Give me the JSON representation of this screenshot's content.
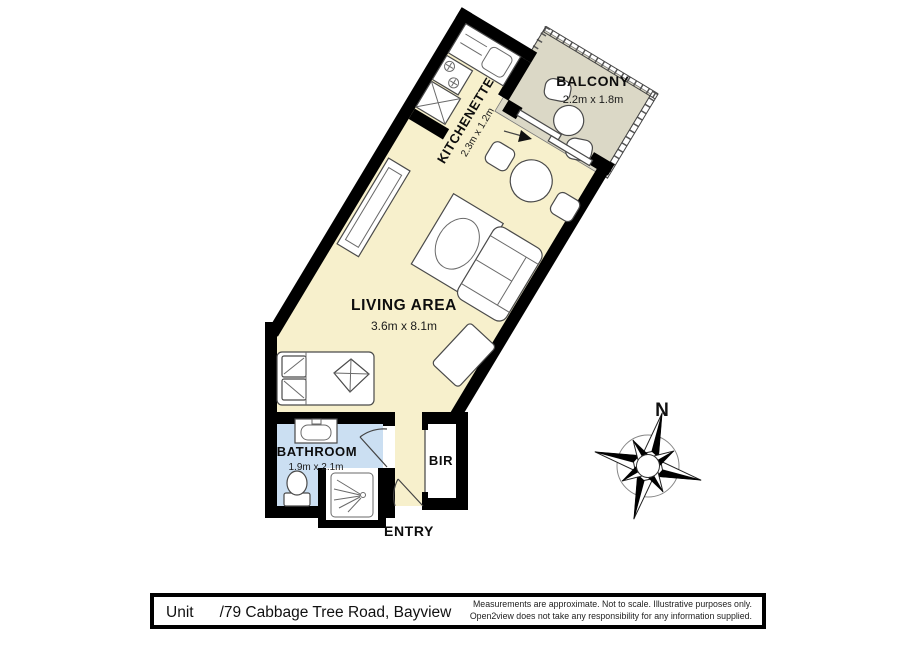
{
  "plan": {
    "balcony": {
      "name": "BALCONY",
      "dim": "2.2m x 1.8m"
    },
    "kitchenette": {
      "name": "KITCHENETTE",
      "dim": "2.3m x 1.2m"
    },
    "living": {
      "name": "LIVING AREA",
      "dim": "3.6m x 8.1m"
    },
    "bathroom": {
      "name": "BATHROOM",
      "dim": "1.9m x 2.1m"
    },
    "bir": {
      "name": "BIR"
    },
    "entry": {
      "name": "ENTRY"
    },
    "compass_north": "N"
  },
  "footer": {
    "address_prefix": "Unit",
    "address": "/79 Cabbage Tree Road, Bayview",
    "disclaimer_line1": "Measurements are approximate. Not to scale. Illustrative purposes only.",
    "disclaimer_line2": "Open2view does not take any responsibility for any information supplied."
  },
  "colors": {
    "floor": "#f7f0cc",
    "balcony": "#dbd8c6",
    "bathroom": "#cbdff2",
    "wall": "#000000"
  }
}
